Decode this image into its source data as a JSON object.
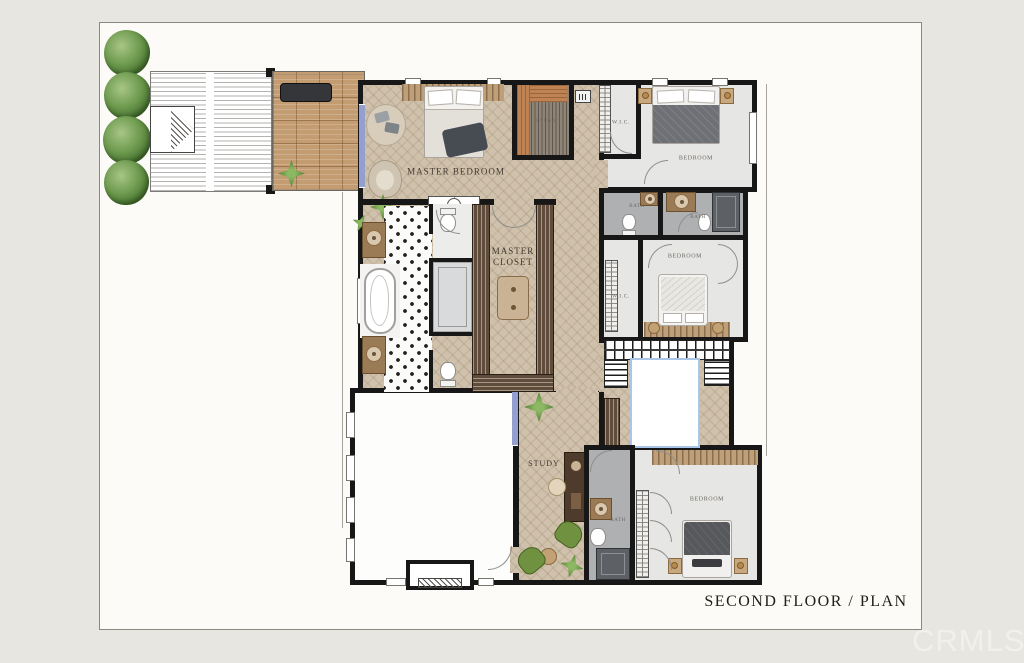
{
  "plan": {
    "title": "SECOND FLOOR / PLAN",
    "watermark": "CRMLS"
  },
  "rooms": {
    "master_bedroom": "MASTER BEDROOM",
    "master_closet": "MASTER CLOSET",
    "sauna": "SAUNA",
    "wic_top": "W.I.C.",
    "wic_mid": "W.I.C.",
    "bedroom_top": "BEDROOM",
    "bedroom_mid": "BEDROOM",
    "bedroom_bottom": "BEDROOM",
    "bath_top_left": "BATH",
    "bath_top_right": "BATH",
    "bath_bottom": "BATH",
    "study": "STUDY"
  },
  "colors": {
    "canvas_bg": "#e8e6e1",
    "frame_bg": "#fcfbf8",
    "wall": "#171717",
    "wood_floor": "#cfc1ab",
    "gray_floor": "#e6e6e5",
    "bath_floor": "#aeb0b2",
    "dark_shower": "#5d6165",
    "wardrobe_wood": "#5f4c3a",
    "balcony_wood": "#c49c72",
    "sauna_wood": "#bf8353",
    "stair_void_outline": "#a9c6e6",
    "window_glass": "#93a0cf",
    "tree_green": "#5d8f46",
    "label_ink": "#40382e"
  }
}
